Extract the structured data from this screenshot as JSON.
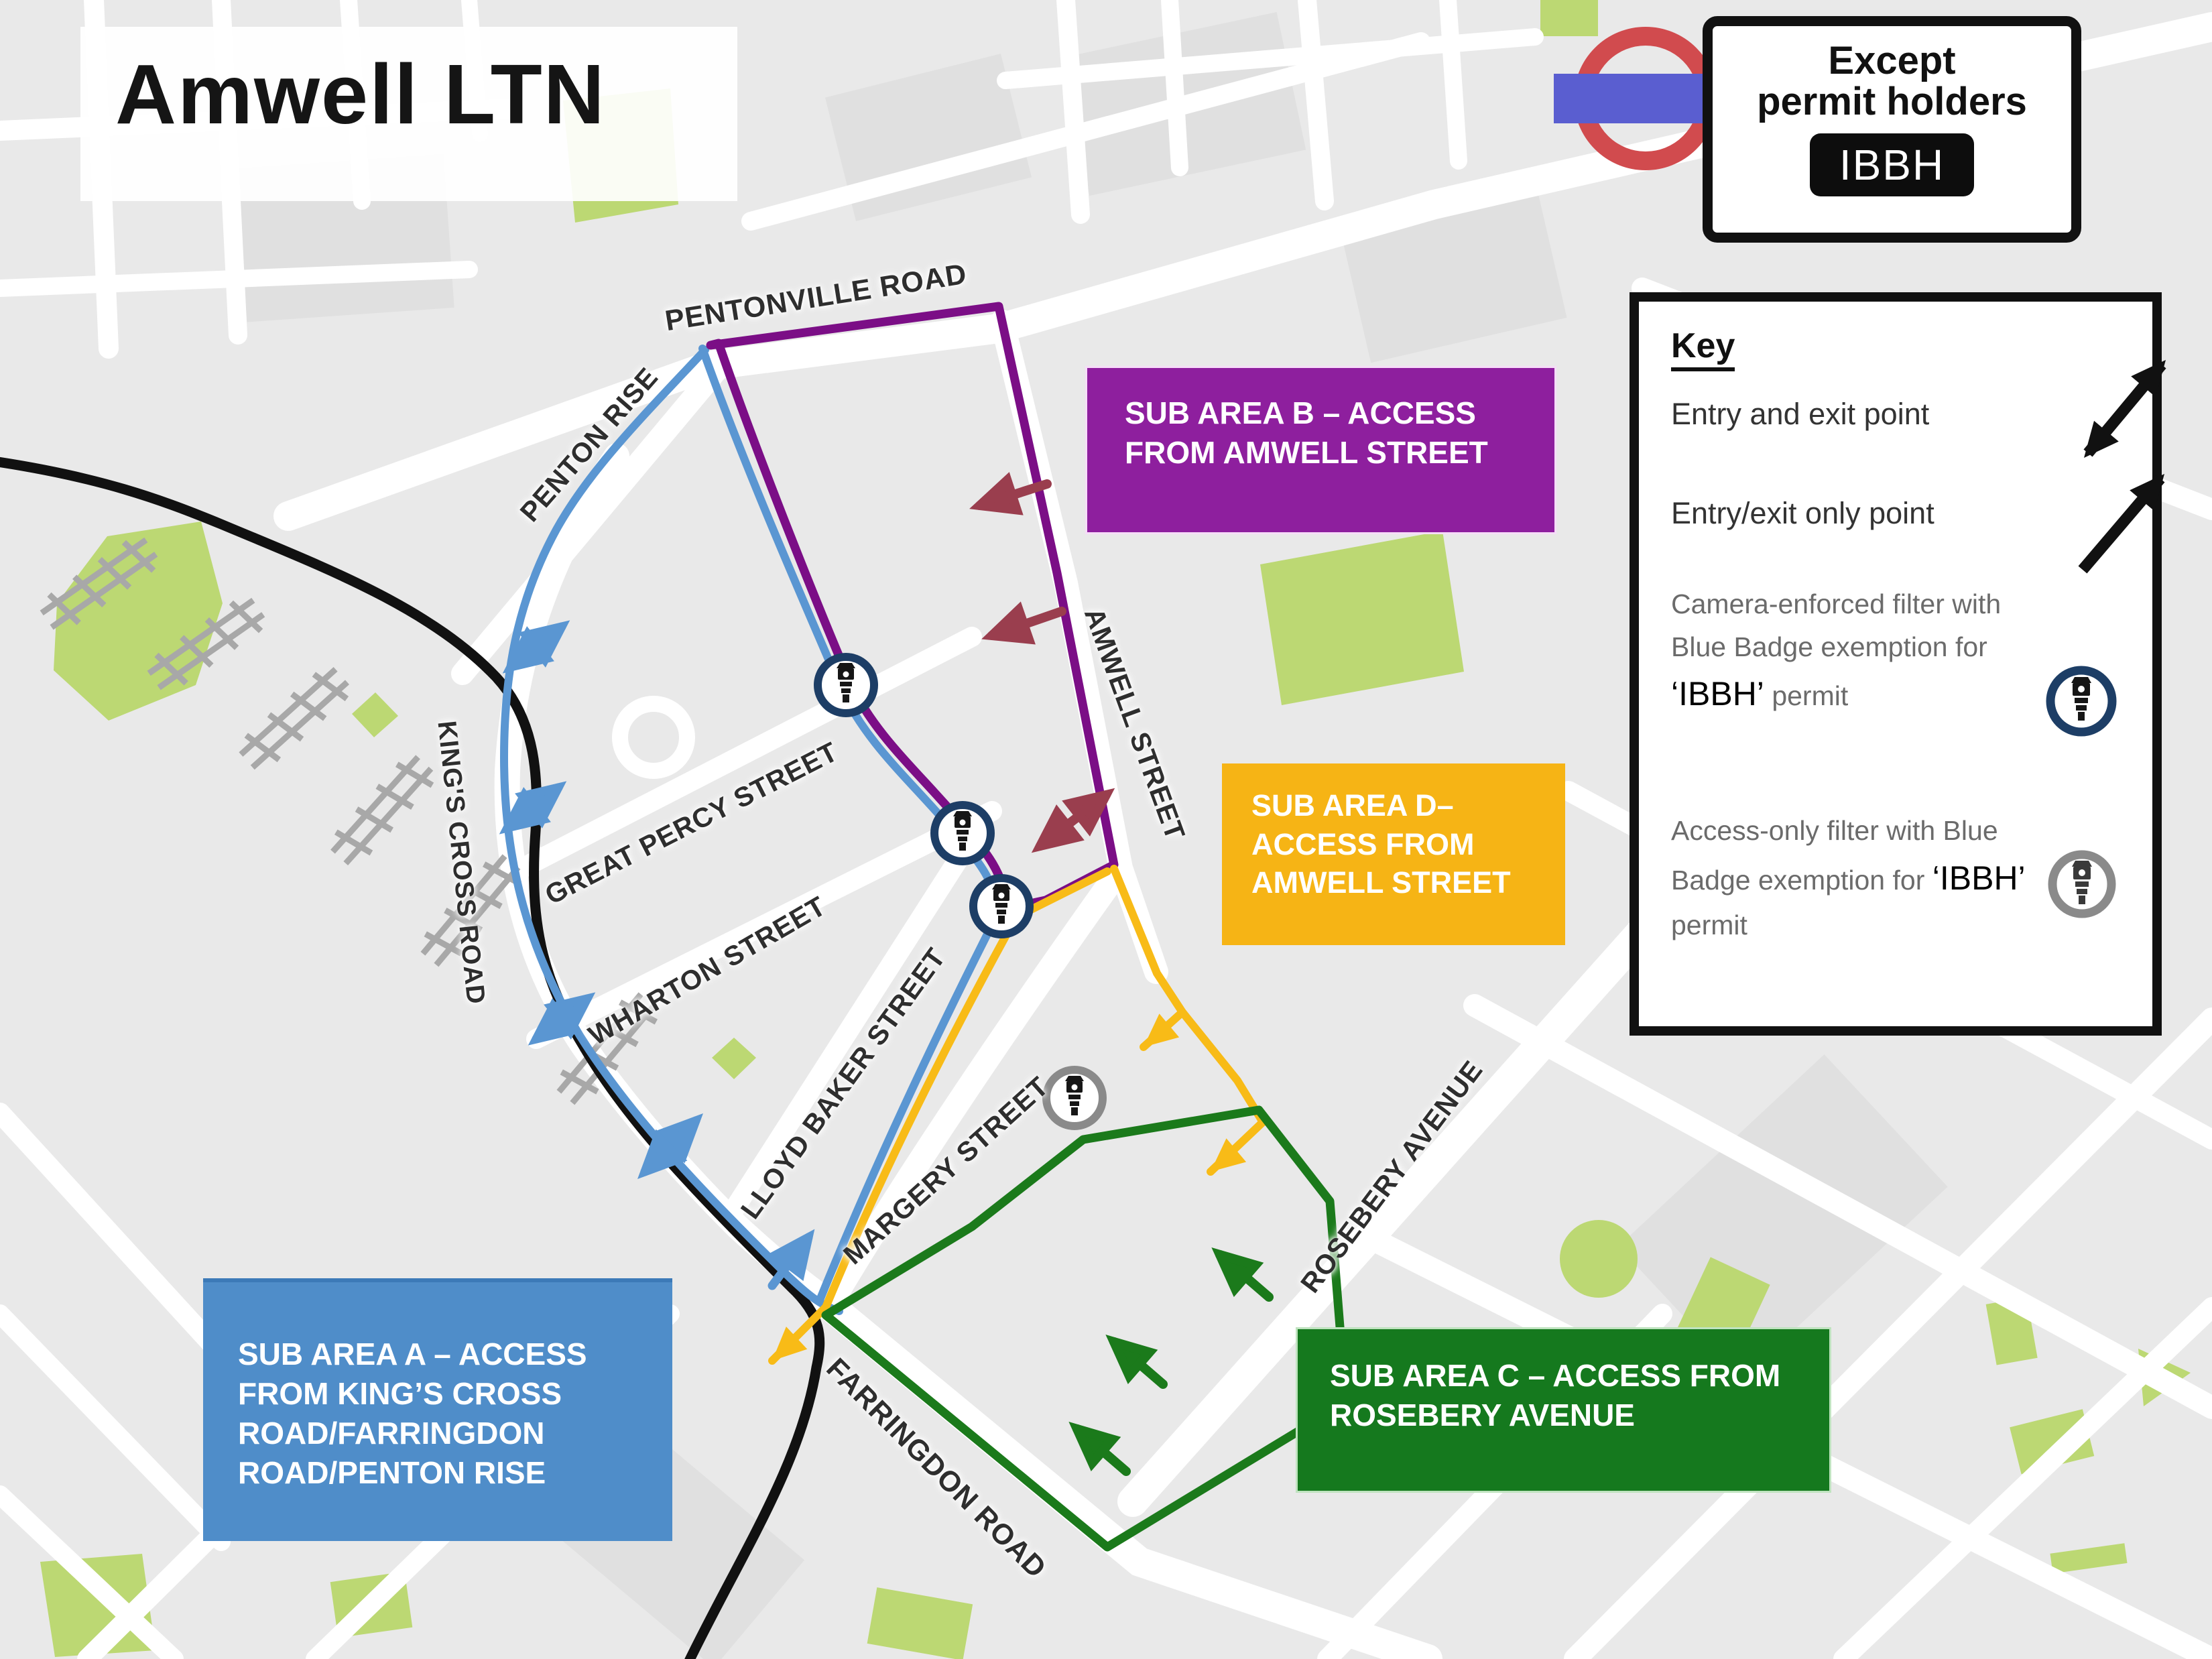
{
  "title": "Amwell LTN",
  "permit_sign": {
    "line1": "Except",
    "line2": "permit holders",
    "plate": "IBBH"
  },
  "key": {
    "heading": "Key",
    "entry_exit": "Entry and exit point",
    "entry_exit_only": "Entry/exit only point",
    "camera_filter_pre": "Camera-enforced filter with Blue Badge exemption for ",
    "camera_filter_code": "‘IBBH’",
    "camera_filter_post": " permit",
    "access_filter_pre": "Access-only filter with Blue Badge exemption for ",
    "access_filter_code": "‘IBBH’",
    "access_filter_post": " permit"
  },
  "streets": {
    "pentonville": "PENTONVILLE ROAD",
    "penton_rise": "PENTON RISE",
    "kings_cross": "KING'S CROSS ROAD",
    "great_percy": "GREAT PERCY STREET",
    "wharton": "WHARTON STREET",
    "lloyd_baker": "LLOYD BAKER STREET",
    "margery": "MARGERY STREET",
    "amwell": "AMWELL STREET",
    "rosebery": "ROSEBERY AVENUE",
    "farringdon": "FARRINGDON ROAD"
  },
  "areas": {
    "a": {
      "label": "SUB AREA A – ACCESS FROM KING’S CROSS ROAD/FARRINGDON ROAD/PENTON RISE",
      "color": "#4f8dc9"
    },
    "b": {
      "label": "SUB AREA B – ACCESS FROM AMWELL STREET",
      "color": "#8e1f9e"
    },
    "c": {
      "label": "SUB AREA C – ACCESS FROM ROSEBERY AVENUE",
      "color": "#15791e"
    },
    "d": {
      "label": "SUB AREA D– ACCESS FROM AMWELL STREET",
      "color": "#f6b415"
    }
  },
  "map_colors": {
    "route_a_blue": "#5a96d2",
    "route_b_purple": "#7b0e86",
    "route_c_green": "#1b7a1b",
    "route_d_yellow": "#f8bb17",
    "restricted_arrow_maroon": "#9a3e4e",
    "railway_black": "#111111",
    "camera_ring_navy": "#1d3e66",
    "camera_ring_grey": "#8a8a8a",
    "park_green": "#bcd873",
    "roundel_red": "#d14b4e",
    "roundel_bar_blue": "#5a5ed0"
  }
}
